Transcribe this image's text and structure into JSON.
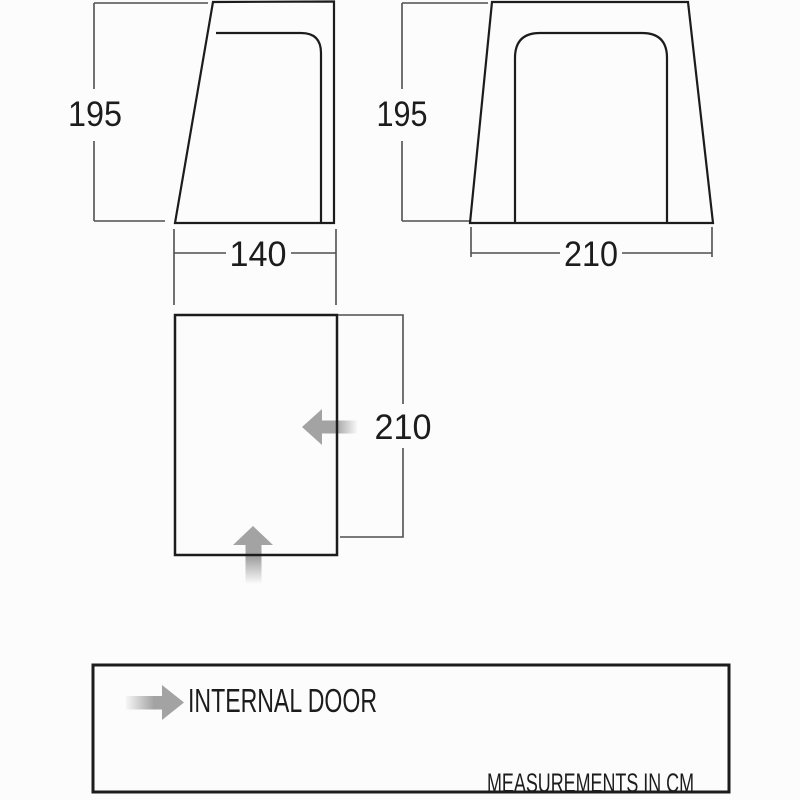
{
  "diagram": {
    "side_view": {
      "height_cm": "195",
      "width_cm": "140"
    },
    "front_view": {
      "height_cm": "195",
      "width_cm": "210"
    },
    "floor_plan": {
      "depth_cm": "210"
    },
    "legend": {
      "door_label": "INTERNAL DOOR",
      "units_label": "MEASUREMENTS IN CM"
    },
    "icons": {
      "floor_plan_side_door": "internal-door-arrow-left",
      "floor_plan_front_door": "internal-door-arrow-up",
      "legend_arrow": "internal-door-arrow-right"
    },
    "colors": {
      "outline": "#1c1c1c",
      "dimension_line": "#4f4f4f",
      "arrow_gray": "#a3a3a3",
      "background": "#fcfcfc"
    }
  }
}
